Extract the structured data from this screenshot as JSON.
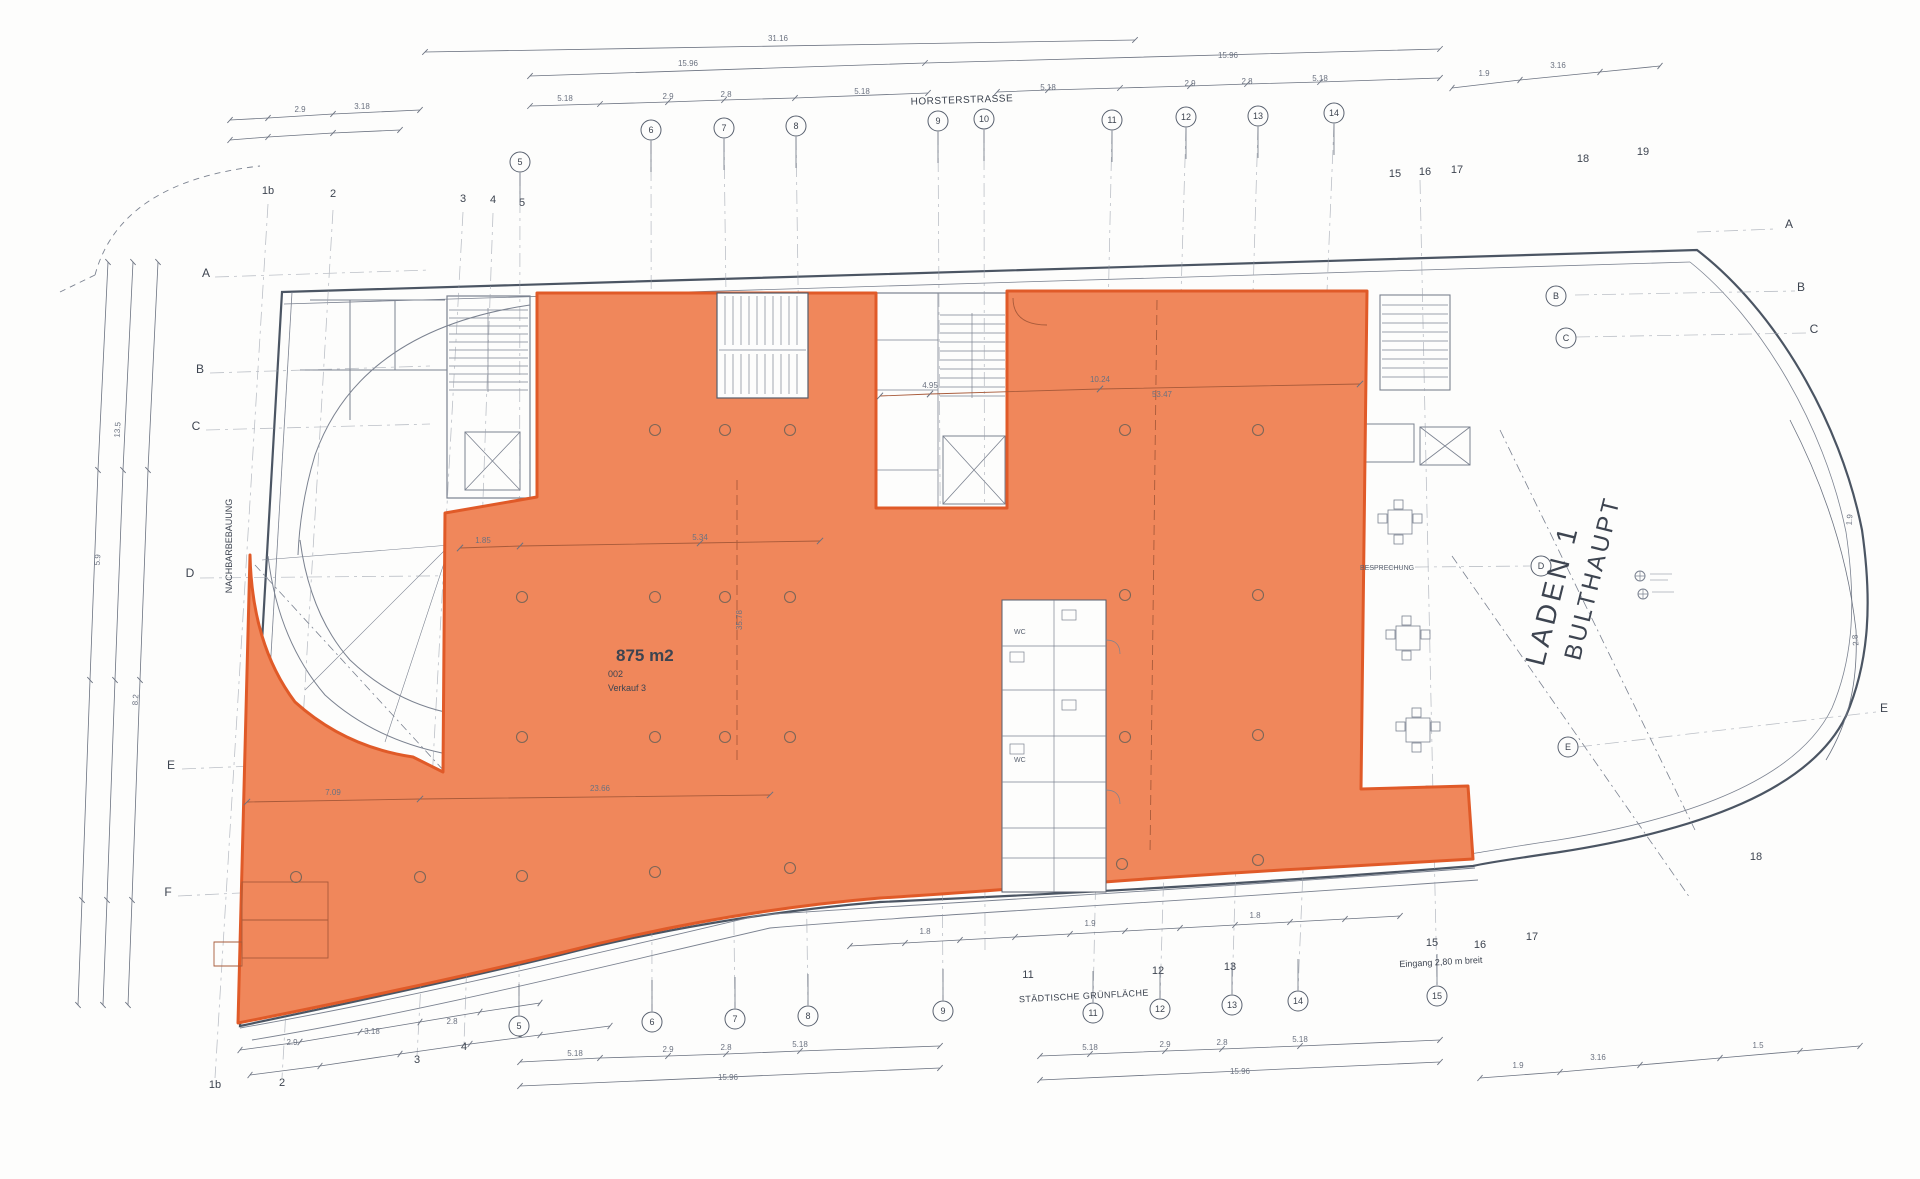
{
  "colors": {
    "highlight_fill": "#F0875B",
    "highlight_stroke": "#E05A28",
    "area_text": "#E8502A",
    "line": "#7B8290",
    "wall": "#4B5563",
    "dim_text": "#6B7280",
    "over_orange_line": "#A85A3A"
  },
  "labels": {
    "street_top": "HORSTERSTRASSE",
    "street_bottom": "STÄDTISCHE GRÜNFLÄCHE",
    "neighbor_left": "NACHBARBEBAUUNG",
    "shop_line1": "LADEN 1",
    "shop_line2": "BULTHAUPT",
    "entrance_note": "Eingang 2,80 m breit",
    "area_value": "875 m2",
    "area_number": "002",
    "area_use": "Verkauf 3",
    "room_wc_1": "WC",
    "room_wc_2": "WC",
    "room_meeting": "BESPRECHUNG"
  },
  "grid_markers": {
    "plain": [
      {
        "t": "1b",
        "x": 268,
        "y": 194
      },
      {
        "t": "2",
        "x": 333,
        "y": 197
      },
      {
        "t": "3",
        "x": 463,
        "y": 202
      },
      {
        "t": "4",
        "x": 493,
        "y": 203
      },
      {
        "t": "5",
        "x": 522,
        "y": 206
      },
      {
        "t": "15",
        "x": 1395,
        "y": 177
      },
      {
        "t": "16",
        "x": 1425,
        "y": 175
      },
      {
        "t": "17",
        "x": 1457,
        "y": 173
      },
      {
        "t": "18",
        "x": 1583,
        "y": 162
      },
      {
        "t": "19",
        "x": 1643,
        "y": 155
      },
      {
        "t": "1b",
        "x": 215,
        "y": 1088
      },
      {
        "t": "2",
        "x": 282,
        "y": 1086
      },
      {
        "t": "3",
        "x": 417,
        "y": 1063
      },
      {
        "t": "4",
        "x": 464,
        "y": 1050
      },
      {
        "t": "5",
        "x": 520,
        "y": 1037
      },
      {
        "t": "11",
        "x": 1028,
        "y": 978
      },
      {
        "t": "12",
        "x": 1158,
        "y": 974
      },
      {
        "t": "13",
        "x": 1230,
        "y": 970
      },
      {
        "t": "15",
        "x": 1432,
        "y": 946
      },
      {
        "t": "16",
        "x": 1480,
        "y": 948
      },
      {
        "t": "17",
        "x": 1532,
        "y": 940
      },
      {
        "t": "18",
        "x": 1756,
        "y": 860
      }
    ],
    "circled": [
      {
        "t": "5",
        "x": 520,
        "y": 162,
        "side": "top"
      },
      {
        "t": "6",
        "x": 651,
        "y": 130,
        "side": "top"
      },
      {
        "t": "7",
        "x": 724,
        "y": 128,
        "side": "top"
      },
      {
        "t": "8",
        "x": 796,
        "y": 126,
        "side": "top"
      },
      {
        "t": "9",
        "x": 938,
        "y": 121,
        "side": "top"
      },
      {
        "t": "10",
        "x": 984,
        "y": 119,
        "side": "top"
      },
      {
        "t": "11",
        "x": 1112,
        "y": 120,
        "side": "top"
      },
      {
        "t": "12",
        "x": 1186,
        "y": 117,
        "side": "top"
      },
      {
        "t": "13",
        "x": 1258,
        "y": 116,
        "side": "top"
      },
      {
        "t": "14",
        "x": 1334,
        "y": 113,
        "side": "top"
      },
      {
        "t": "5",
        "x": 519,
        "y": 1026,
        "side": "bottom"
      },
      {
        "t": "6",
        "x": 652,
        "y": 1022,
        "side": "bottom"
      },
      {
        "t": "7",
        "x": 735,
        "y": 1019,
        "side": "bottom"
      },
      {
        "t": "8",
        "x": 808,
        "y": 1016,
        "side": "bottom"
      },
      {
        "t": "9",
        "x": 943,
        "y": 1011,
        "side": "bottom"
      },
      {
        "t": "11",
        "x": 1093,
        "y": 1013,
        "side": "bottom"
      },
      {
        "t": "12",
        "x": 1160,
        "y": 1009,
        "side": "bottom"
      },
      {
        "t": "13",
        "x": 1232,
        "y": 1005,
        "side": "bottom"
      },
      {
        "t": "14",
        "x": 1298,
        "y": 1001,
        "side": "bottom"
      },
      {
        "t": "15",
        "x": 1437,
        "y": 996,
        "side": "bottom"
      },
      {
        "t": "D",
        "x": 1541,
        "y": 566,
        "side": "none"
      },
      {
        "t": "B",
        "x": 1556,
        "y": 296,
        "side": "none"
      },
      {
        "t": "C",
        "x": 1566,
        "y": 338,
        "side": "none"
      },
      {
        "t": "E",
        "x": 1568,
        "y": 747,
        "side": "none"
      }
    ],
    "letters": [
      {
        "t": "A",
        "x": 206,
        "y": 277
      },
      {
        "t": "B",
        "x": 200,
        "y": 373
      },
      {
        "t": "C",
        "x": 196,
        "y": 430
      },
      {
        "t": "D",
        "x": 190,
        "y": 577
      },
      {
        "t": "E",
        "x": 171,
        "y": 769
      },
      {
        "t": "F",
        "x": 168,
        "y": 896
      },
      {
        "t": "A",
        "x": 1789,
        "y": 228
      },
      {
        "t": "B",
        "x": 1801,
        "y": 291
      },
      {
        "t": "C",
        "x": 1814,
        "y": 333
      },
      {
        "t": "E",
        "x": 1884,
        "y": 712
      }
    ]
  },
  "dim_labels": [
    {
      "t": "31.16",
      "x": 778,
      "y": 41
    },
    {
      "t": "15.96",
      "x": 688,
      "y": 66
    },
    {
      "t": "15.96",
      "x": 1228,
      "y": 58
    },
    {
      "t": "5.18",
      "x": 565,
      "y": 101
    },
    {
      "t": "2.9",
      "x": 668,
      "y": 99
    },
    {
      "t": "2.8",
      "x": 726,
      "y": 97
    },
    {
      "t": "5.18",
      "x": 862,
      "y": 94
    },
    {
      "t": "5.18",
      "x": 1048,
      "y": 90
    },
    {
      "t": "2.9",
      "x": 1190,
      "y": 86
    },
    {
      "t": "2.8",
      "x": 1247,
      "y": 84
    },
    {
      "t": "5.18",
      "x": 1320,
      "y": 81
    },
    {
      "t": "2.9",
      "x": 300,
      "y": 112
    },
    {
      "t": "3.18",
      "x": 362,
      "y": 109
    },
    {
      "t": "1.9",
      "x": 1484,
      "y": 76
    },
    {
      "t": "3.16",
      "x": 1558,
      "y": 68
    },
    {
      "t": "5.18",
      "x": 575,
      "y": 1056
    },
    {
      "t": "2.9",
      "x": 668,
      "y": 1052
    },
    {
      "t": "2.8",
      "x": 726,
      "y": 1050
    },
    {
      "t": "5.18",
      "x": 800,
      "y": 1047
    },
    {
      "t": "15.96",
      "x": 728,
      "y": 1080
    },
    {
      "t": "5.18",
      "x": 1090,
      "y": 1050
    },
    {
      "t": "2.9",
      "x": 1165,
      "y": 1047
    },
    {
      "t": "2.8",
      "x": 1222,
      "y": 1045
    },
    {
      "t": "5.18",
      "x": 1300,
      "y": 1042
    },
    {
      "t": "15.96",
      "x": 1240,
      "y": 1074
    },
    {
      "t": "2.9",
      "x": 292,
      "y": 1045
    },
    {
      "t": "3.18",
      "x": 372,
      "y": 1034
    },
    {
      "t": "2.8",
      "x": 452,
      "y": 1024
    },
    {
      "t": "1.8",
      "x": 925,
      "y": 934
    },
    {
      "t": "1.9",
      "x": 1090,
      "y": 926
    },
    {
      "t": "1.8",
      "x": 1255,
      "y": 918
    },
    {
      "t": "1.9",
      "x": 1518,
      "y": 1068
    },
    {
      "t": "3.16",
      "x": 1598,
      "y": 1060
    },
    {
      "t": "1.5",
      "x": 1758,
      "y": 1048
    },
    {
      "t": "1.85",
      "x": 483,
      "y": 543
    },
    {
      "t": "5.34",
      "x": 700,
      "y": 540
    },
    {
      "t": "7.09",
      "x": 333,
      "y": 795
    },
    {
      "t": "23.66",
      "x": 600,
      "y": 791
    },
    {
      "t": "4.95",
      "x": 930,
      "y": 388
    },
    {
      "t": "10.24",
      "x": 1100,
      "y": 382
    },
    {
      "t": "53.47",
      "x": 1162,
      "y": 397
    },
    {
      "t": "35.78",
      "x": 742,
      "y": 620,
      "r": -90
    },
    {
      "t": "1.9",
      "x": 1852,
      "y": 520,
      "r": -85
    },
    {
      "t": "2.8",
      "x": 1858,
      "y": 640,
      "r": -95
    },
    {
      "t": "13.5",
      "x": 120,
      "y": 430,
      "r": -86
    },
    {
      "t": "5.9",
      "x": 100,
      "y": 560,
      "r": -86
    },
    {
      "t": "8.2",
      "x": 138,
      "y": 700,
      "r": -86
    }
  ],
  "columns": [
    [
      655,
      430
    ],
    [
      725,
      430
    ],
    [
      790,
      430
    ],
    [
      1125,
      430
    ],
    [
      1258,
      430
    ],
    [
      522,
      597
    ],
    [
      655,
      597
    ],
    [
      725,
      597
    ],
    [
      790,
      597
    ],
    [
      1125,
      595
    ],
    [
      1258,
      595
    ],
    [
      522,
      737
    ],
    [
      655,
      737
    ],
    [
      725,
      737
    ],
    [
      790,
      737
    ],
    [
      1125,
      737
    ],
    [
      1258,
      735
    ],
    [
      296,
      877
    ],
    [
      420,
      877
    ],
    [
      522,
      876
    ],
    [
      655,
      872
    ],
    [
      790,
      868
    ],
    [
      1122,
      864
    ],
    [
      1258,
      860
    ]
  ]
}
